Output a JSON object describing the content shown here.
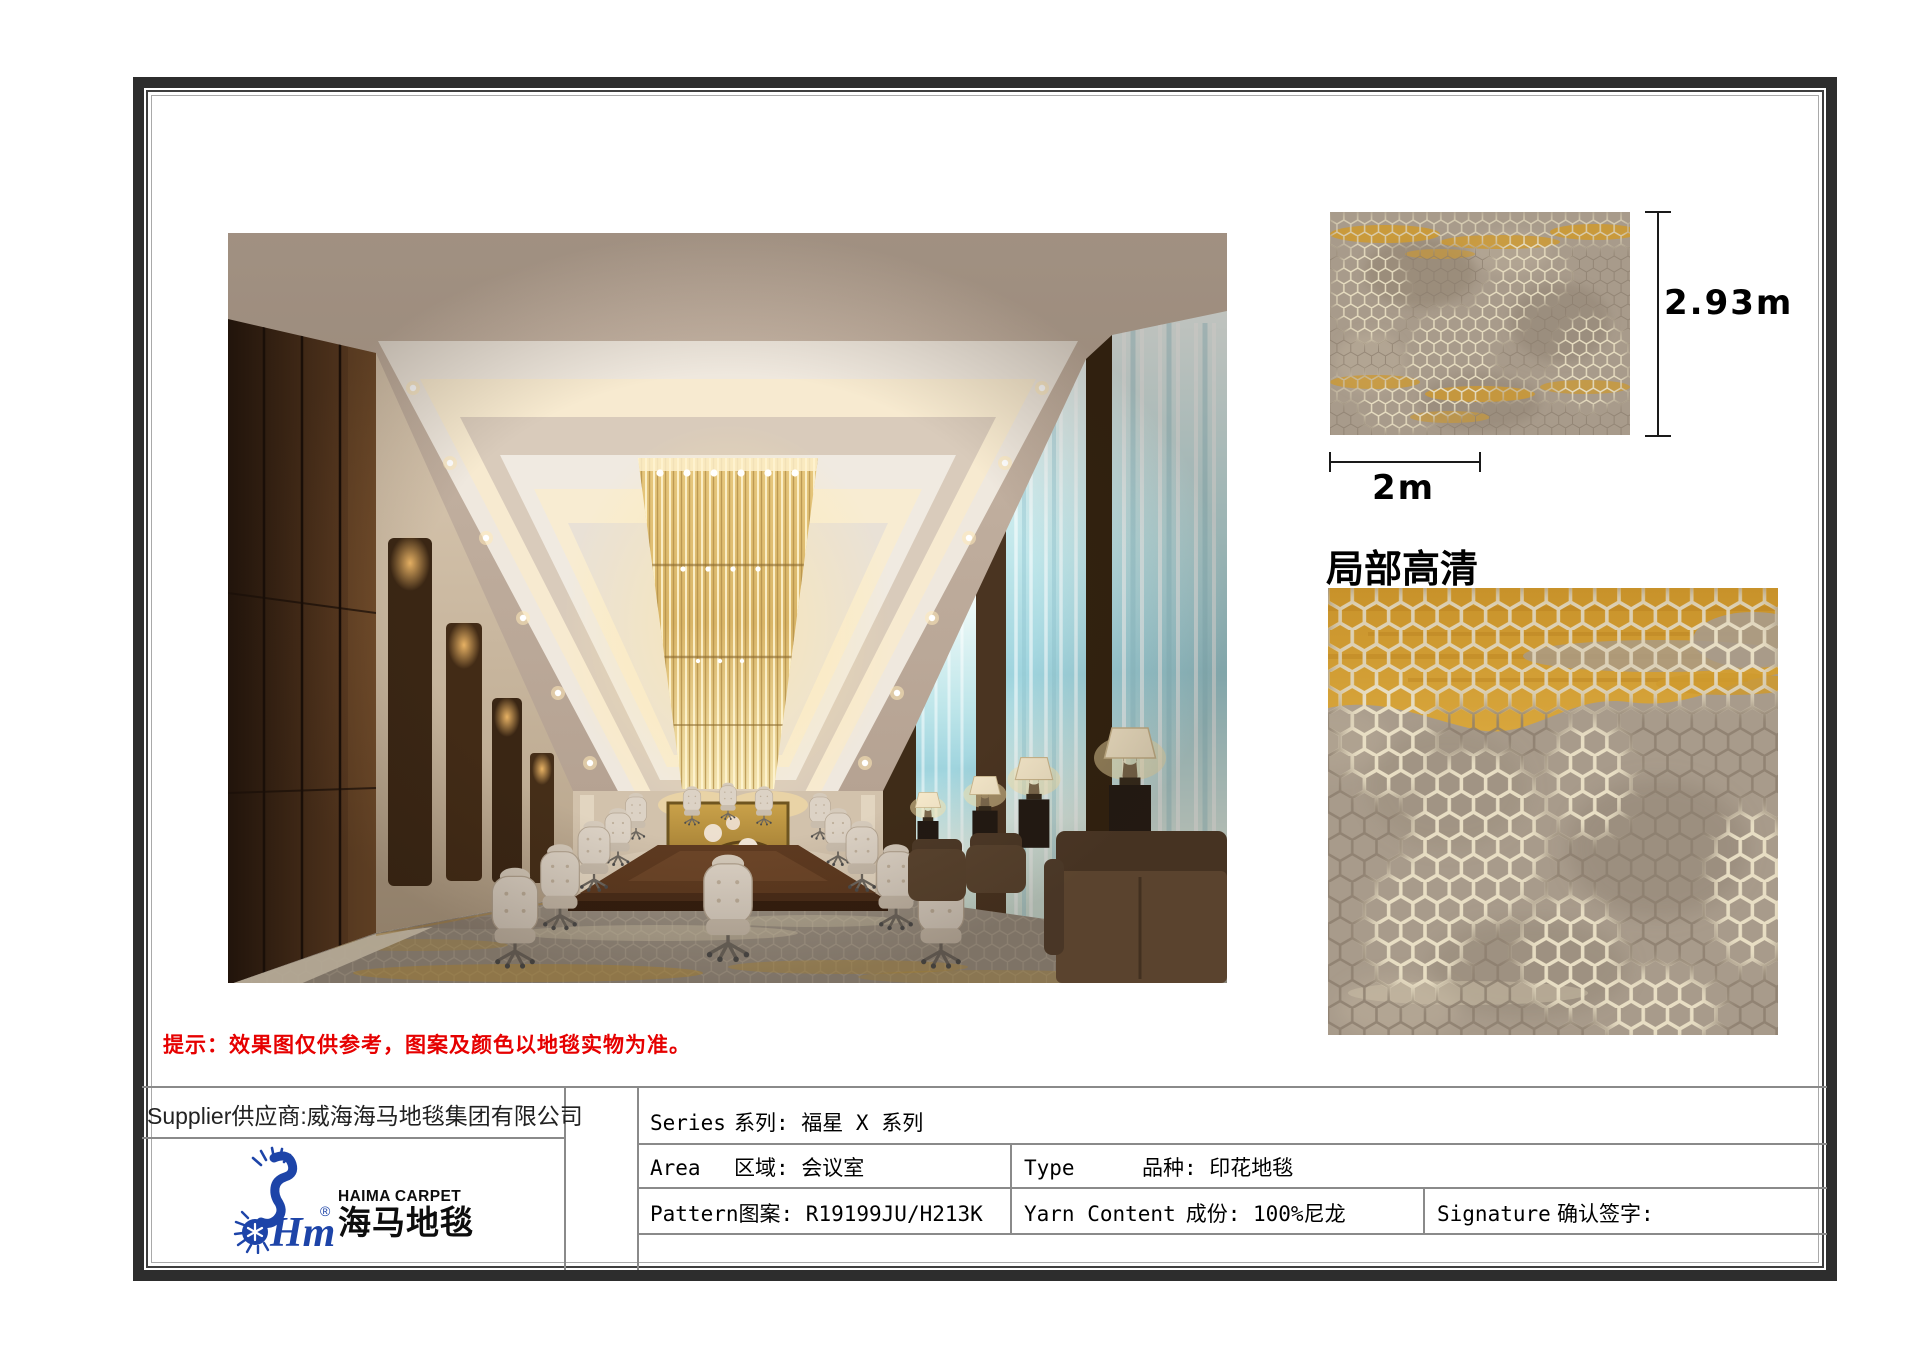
{
  "page": {
    "dim_height": "2.93m",
    "dim_width": "2m",
    "detail_title": "局部高清",
    "notice": "提示：效果图仅供参考，图案及颜色以地毯实物为准。"
  },
  "table": {
    "supplier": "Supplier供应商:威海海马地毯集团有限公司",
    "logo": {
      "brand_en": "HAIMA CARPET",
      "brand_cn": "海马地毯",
      "monogram": "Hm",
      "reg": "®"
    },
    "rows": {
      "series": {
        "en": "Series",
        "cn": "系列: 福星 X 系列"
      },
      "area": {
        "en": "Area",
        "cn": "区域: 会议室"
      },
      "type": {
        "en": "Type",
        "cn": "品种: 印花地毯"
      },
      "pattern": {
        "en": "Pattern",
        "cn": "图案: R19199JU/H213K"
      },
      "yarn": {
        "en": "Yarn Content",
        "cn": "成份: 100%尼龙"
      },
      "signature": {
        "en": "Signature",
        "cn": "确认签字:"
      }
    }
  },
  "colors": {
    "carpet_gold": "#cf9a2e",
    "carpet_taupe": "#a89b8b",
    "carpet_cream": "#e6dcc0",
    "carpet_dark": "#8b7d6d",
    "logo_blue": "#1d44a8",
    "notice_red": "#e60000",
    "frame_dark": "#2d2d2d"
  }
}
